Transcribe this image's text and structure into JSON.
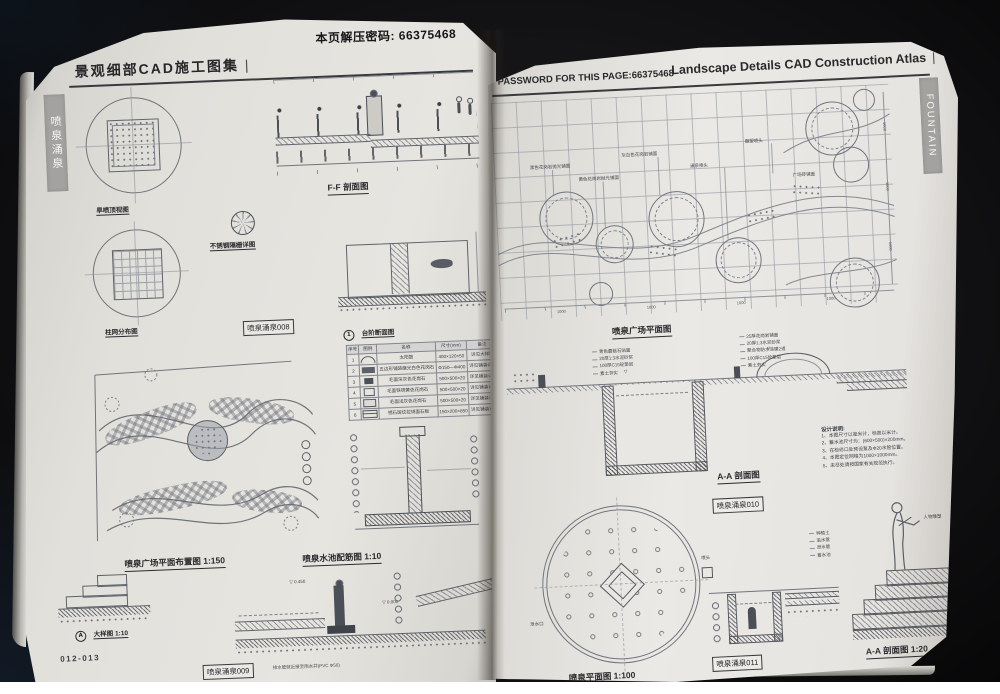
{
  "symbols": {
    "elev": "▽"
  },
  "left_page": {
    "password_note": "本页解压密码: 66375468",
    "header": "景观细部CAD施工图集",
    "header_mark": "|",
    "side_tab": "喷泉涌泉",
    "page_number": "012-013",
    "labels": {
      "top_view": "旱喷顶视图",
      "ff_section": "F-F 剖面图",
      "grate_detail": "不锈钢隔栅详图",
      "column_grid": "柱网分布图",
      "step_no": "1",
      "step_section": "台阶断面图",
      "plaza_plan": "喷泉广场平面布置图 1:150",
      "rebar_plan": "喷泉水池配筋图 1:10",
      "detail_no": "A",
      "detail": "大样图 1:10",
      "ref008": "喷泉涌泉008",
      "ref009": "喷泉涌泉009"
    },
    "elevations": {
      "e1": "0.450",
      "e2": "0.000"
    },
    "drain_note": "排水管就近接至雨水井(PVC Φ50)",
    "table": {
      "headers": [
        "序号",
        "图例",
        "名称",
        "尺寸(mm)",
        "备注"
      ],
      "rows": [
        {
          "no": "1",
          "name": "太阳鼓",
          "size": "400×120×50",
          "note": "详见大样图"
        },
        {
          "no": "2",
          "name": "五边形铺装磨光白色花岗石",
          "size": "Φ150—Φ400",
          "note": "详见铺装详图"
        },
        {
          "no": "3",
          "name": "毛面深灰色花岗石",
          "size": "500×500×20",
          "note": "详见铺装详图"
        },
        {
          "no": "4",
          "name": "毛面铁锈黄色花岗石",
          "size": "500×500×20",
          "note": "详见铺装详图"
        },
        {
          "no": "5",
          "name": "毛面浅灰色花岗石",
          "size": "500×500×20",
          "note": "详见铺装详图"
        },
        {
          "no": "6",
          "name": "锈石斑纹拉烧面石板",
          "size": "150×200×850",
          "note": "详见铺装详图"
        }
      ]
    }
  },
  "right_page": {
    "password_label": "PASSWORD FOR THIS PAGE:66375468",
    "header": "Landscape Details CAD Construction Atlas",
    "header_mark": "|",
    "side_tab": "FOUNTAIN",
    "grid_dim": "1000",
    "labels": {
      "plaza_plan": "喷泉广场平面图",
      "aa_section": "A-A 剖面图",
      "ref010": "喷泉涌泉010",
      "fountain_plan": "喷泉平面图 1:100",
      "ref011": "喷泉涌泉011",
      "aa_section_20": "A-A 剖面图 1:20"
    },
    "plan_annotations": [
      "黑色花岗岩抛光铺面",
      "黄色花岗岩抛光铺面",
      "灰白色花岗岩铺面",
      "涌泉喷头",
      "雕塑喷头",
      "广场砖铺面"
    ],
    "spec_stack1": [
      "青色蘑菇石贴面",
      "20厚1:3水泥砂浆",
      "100厚C15砼垫层",
      "素土夯实"
    ],
    "spec_stack2": [
      "25厚花岗岩铺面",
      "20厚1:3水泥砂浆",
      "聚合物防水涂膜2道",
      "100厚C15砼垫层",
      "素土夯实"
    ],
    "section_annotations": [
      "种植土",
      "溢水管",
      "泄水管",
      "蓄水池"
    ],
    "nozzle_annotations": [
      "喷头",
      "泄水口"
    ],
    "statue_note": "人物雕塑",
    "notes": {
      "title": "设计说明:",
      "items": [
        "1、本图尺寸以毫米计，标高以米计。",
        "2、蓄水池尺寸为：(600×500)×200mm。",
        "3、在检修口处预设泵及Φ20水管位置。",
        "4、本图定位网格为1000×1000mm。",
        "5、未尽处请按国家有关规范执行。"
      ]
    }
  }
}
